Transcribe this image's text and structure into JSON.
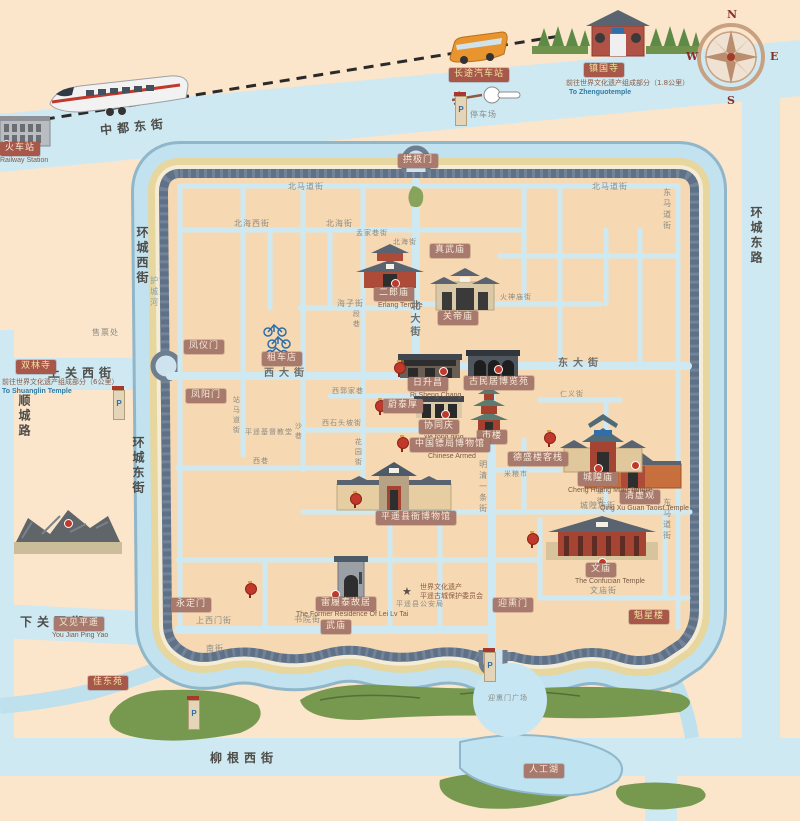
{
  "compass": {
    "n": "N",
    "e": "E",
    "s": "S",
    "w": "W"
  },
  "gates": [
    {
      "label": "拱极门"
    },
    {
      "label": "凤仪门"
    },
    {
      "label": "凤阳门"
    },
    {
      "label": "永定门"
    },
    {
      "label": "迎熏门"
    }
  ],
  "pois": [
    {
      "label": "火车站",
      "eng": "Railway Station"
    },
    {
      "label": "长途汽车站"
    },
    {
      "label": "镇国寺",
      "note": "前往世界文化遗产组成部分（1.8公里）",
      "eng": "To Zhenguotemple"
    },
    {
      "label": "双林寺",
      "note": "前往世界文化遗产组成部分（6公里）",
      "eng": "To Shuanglin Temple"
    },
    {
      "label": "二郎庙",
      "eng": "Erlang Temple"
    },
    {
      "label": "真武庙"
    },
    {
      "label": "关帝庙"
    },
    {
      "label": "清虚观",
      "eng": "Qing Xu Guan Taoist Temple"
    },
    {
      "label": "日升昌",
      "eng": "Ri Sheng Chang"
    },
    {
      "label": "古民居博览苑"
    },
    {
      "label": "蔚泰厚"
    },
    {
      "label": "协同庆",
      "eng": "xie tong qing"
    },
    {
      "label": "市楼"
    },
    {
      "label": "中国镖局博物馆",
      "eng": "Chinese Armed"
    },
    {
      "label": "德盛楼客栈"
    },
    {
      "label": "平遥县衙博物馆"
    },
    {
      "label": "城隍庙",
      "eng": "Cheng Huang Miao Temple"
    },
    {
      "label": "文庙",
      "eng": "The Confucian Temple"
    },
    {
      "label": "雷履泰故居",
      "eng": "The Former Residence Of Lei Lv Tai"
    },
    {
      "label": "武庙"
    },
    {
      "label": "魁星楼"
    },
    {
      "label": "又见平遥",
      "eng": "You Jian Ping Yao"
    },
    {
      "label": "人工湖"
    },
    {
      "label": "佳东苑"
    },
    {
      "label": "租车店"
    }
  ],
  "texts": [
    {
      "label": "停车场"
    },
    {
      "label": "售票处"
    },
    {
      "label": "迎熏门广场"
    },
    {
      "label": "平遥基督教堂"
    },
    {
      "label": "平遥县公安局"
    },
    {
      "label": "世界文化遗产"
    },
    {
      "label": "平遥古城保护委员会"
    }
  ],
  "streets": [
    {
      "label": "中都东街"
    },
    {
      "label": "上关西街"
    },
    {
      "label": "下关西街"
    },
    {
      "label": "柳根西街"
    },
    {
      "label": "顺城路"
    },
    {
      "label": "环城西街"
    },
    {
      "label": "护城河"
    },
    {
      "label": "环城东街"
    },
    {
      "label": "环城东路"
    },
    {
      "label": "北马道街"
    },
    {
      "label": "东马道街"
    },
    {
      "label": "北大街"
    },
    {
      "label": "西大街"
    },
    {
      "label": "东大街"
    },
    {
      "label": "明清一条街"
    },
    {
      "label": "城隍庙街"
    },
    {
      "label": "文庙街"
    },
    {
      "label": "书院街"
    },
    {
      "label": "上西门街"
    },
    {
      "label": "南街"
    },
    {
      "label": "北海西街"
    },
    {
      "label": "北海街"
    },
    {
      "label": "孟家巷街"
    },
    {
      "label": "海子街"
    },
    {
      "label": "段巷"
    },
    {
      "label": "站马道街"
    },
    {
      "label": "沙巷"
    },
    {
      "label": "西郭家巷"
    },
    {
      "label": "西石头坡街"
    },
    {
      "label": "花园街"
    },
    {
      "label": "西巷"
    },
    {
      "label": "火神庙街"
    },
    {
      "label": "仁义街"
    },
    {
      "label": "安家街"
    },
    {
      "label": "米粮市"
    }
  ],
  "colors": {
    "city_fill": "#f6d9b2",
    "road": "#cfe9f3",
    "moat": "#c2e2ef",
    "wall": "#5f7186",
    "shore": "#e7d69e",
    "green": "#76984f",
    "label_bg": "#a87a6e",
    "label_red": "#a8584a",
    "marker_red": "#c0392b"
  }
}
